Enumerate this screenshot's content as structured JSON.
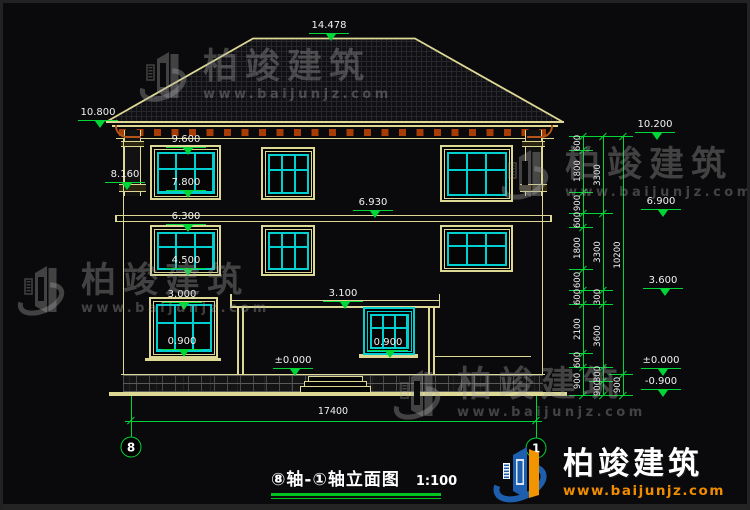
{
  "drawing": {
    "title": "⑧轴-①轴立面图",
    "scale": "1:100",
    "axis_left_bubble": "8",
    "axis_right_bubble": "1",
    "bottom_dimension": "17400"
  },
  "levels": [
    {
      "v": "14.478",
      "x": 326,
      "y": 30
    },
    {
      "v": "10.800",
      "x": 95,
      "y": 117
    },
    {
      "v": "9.600",
      "x": 183,
      "y": 144
    },
    {
      "v": "8.160",
      "x": 122,
      "y": 179
    },
    {
      "v": "7.800",
      "x": 183,
      "y": 187
    },
    {
      "v": "6.300",
      "x": 183,
      "y": 221
    },
    {
      "v": "6.930",
      "x": 370,
      "y": 207
    },
    {
      "v": "4.500",
      "x": 183,
      "y": 265
    },
    {
      "v": "3.000",
      "x": 179,
      "y": 299
    },
    {
      "v": "3.100",
      "x": 340,
      "y": 298
    },
    {
      "v": "0.900",
      "x": 179,
      "y": 346
    },
    {
      "v": "0.900",
      "x": 385,
      "y": 347
    },
    {
      "v": "±0.000",
      "x": 290,
      "y": 365
    },
    {
      "v": "10.200",
      "x": 652,
      "y": 129
    },
    {
      "v": "6.900",
      "x": 658,
      "y": 206
    },
    {
      "v": "3.600",
      "x": 660,
      "y": 285
    },
    {
      "v": "±0.000",
      "x": 658,
      "y": 365
    },
    {
      "v": "-0.900",
      "x": 658,
      "y": 386
    }
  ],
  "dim_columns": [
    {
      "x": 580,
      "boundaries": [
        133,
        147,
        189,
        210,
        224,
        266,
        287,
        301,
        350,
        364,
        392
      ],
      "labels": [
        "600",
        "1800",
        "900",
        "600",
        "1800",
        "600",
        "600",
        "2100",
        "600",
        "900"
      ]
    },
    {
      "x": 600,
      "boundaries": [
        133,
        210,
        287,
        301,
        364,
        378,
        392
      ],
      "labels": [
        "3300",
        "3300",
        "300",
        "3600",
        "300",
        "900"
      ]
    },
    {
      "x": 620,
      "boundaries": [
        133,
        371,
        392
      ],
      "labels": [
        "10200",
        "900"
      ]
    }
  ],
  "bottom_dim": {
    "value": "17400",
    "x1": 128,
    "x2": 533,
    "y": 418,
    "text_x": 330,
    "text_y": 409
  },
  "axis_bubbles": [
    {
      "label": "8",
      "x": 128,
      "y": 444
    },
    {
      "label": "1",
      "x": 533,
      "y": 445
    }
  ],
  "windows": [
    {
      "x": 147,
      "y": 142,
      "w": 71,
      "h": 55,
      "porch": false
    },
    {
      "x": 258,
      "y": 144,
      "w": 54,
      "h": 53,
      "porch": false
    },
    {
      "x": 437,
      "y": 142,
      "w": 73,
      "h": 57,
      "porch": false
    },
    {
      "x": 147,
      "y": 222,
      "w": 71,
      "h": 51,
      "porch": false
    },
    {
      "x": 258,
      "y": 222,
      "w": 54,
      "h": 51,
      "porch": false
    },
    {
      "x": 437,
      "y": 222,
      "w": 73,
      "h": 47,
      "porch": false
    },
    {
      "x": 146,
      "y": 294,
      "w": 69,
      "h": 61,
      "porch": false
    },
    {
      "x": 360,
      "y": 304,
      "w": 52,
      "h": 48,
      "porch": true
    }
  ],
  "watermark": {
    "name": "柏竣建筑",
    "url": "www.baijunjz.com"
  },
  "watermark_positions": [
    {
      "x": 136,
      "y": 44
    },
    {
      "x": 498,
      "y": 142
    },
    {
      "x": 14,
      "y": 258
    },
    {
      "x": 390,
      "y": 362
    }
  ],
  "logo": {
    "name": "柏竣建筑",
    "url": "www.baijunjz.com",
    "x": 490,
    "y": 438
  }
}
